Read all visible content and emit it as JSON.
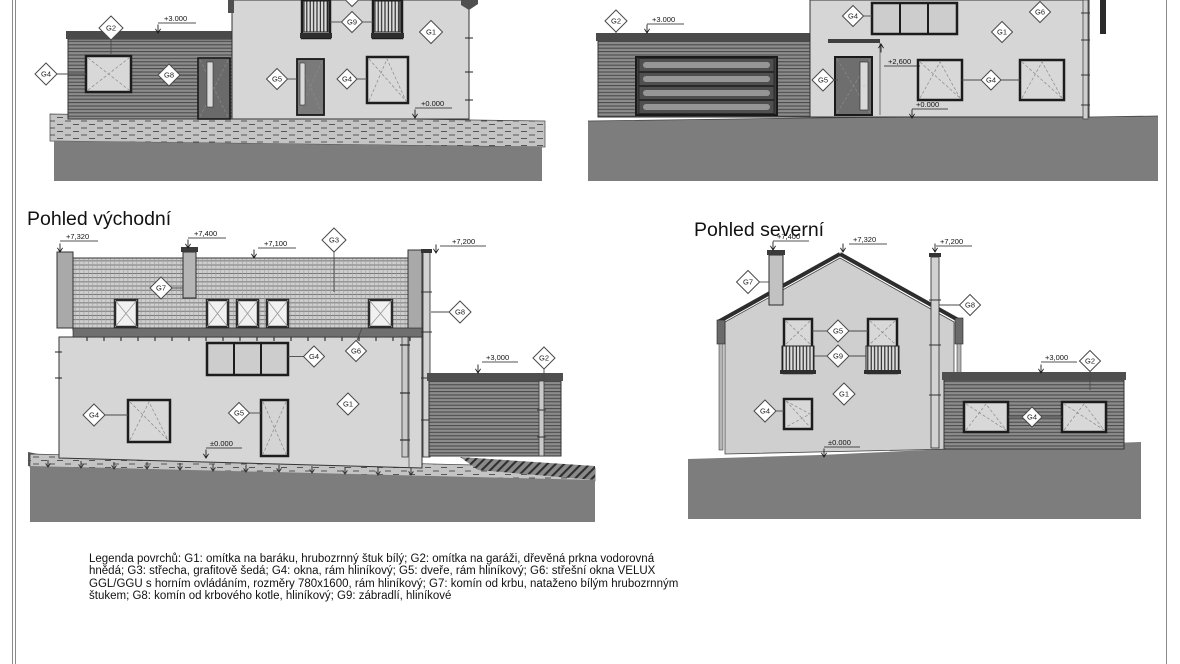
{
  "sheet": {
    "background": "#ffffff",
    "colors": {
      "wall": "#d6d6d6",
      "wood_cladding": "#8c8c8c",
      "roof_tiles": "#cecece",
      "ground": "#7d7d7d",
      "dark_band": "#4a4a4a"
    }
  },
  "elevations": {
    "top_left": {
      "markers": {
        "g2": "G2",
        "g4": "G4",
        "g8": "G8",
        "g9": "G9",
        "g1": "G1",
        "g5": "G5",
        "g4b": "G4"
      },
      "levels": {
        "roof": "+3.000",
        "ground": "+0.000"
      }
    },
    "top_right": {
      "markers": {
        "g2": "G2",
        "g4_top": "G4",
        "g6": "G6",
        "g1": "G1",
        "g5": "G5",
        "g4_mid": "G4"
      },
      "levels": {
        "roof": "+3.000",
        "canopy": "+2,600",
        "ground": "+0.000"
      }
    },
    "east": {
      "title": "Pohled východní",
      "markers": {
        "g3": "G3",
        "g7": "G7",
        "g6": "G6",
        "g8": "G8",
        "g4_top": "G4",
        "g4_left": "G4",
        "g5": "G5",
        "g1": "G1",
        "g2": "G2"
      },
      "levels": {
        "ridge": "+7,320",
        "chimney": "+7,400",
        "eaves": "+7,100",
        "pipe": "+7,200",
        "garage": "+3,000",
        "ground": "±0.000"
      }
    },
    "north": {
      "title": "Pohled severní",
      "markers": {
        "g7": "G7",
        "g8": "G8",
        "g5": "G5",
        "g9": "G9",
        "g1": "G1",
        "g4": "G4",
        "g4_garage": "G4",
        "g2": "G2"
      },
      "levels": {
        "chimney": "+7,400",
        "ridge": "+7,320",
        "pipe": "+7,200",
        "garage": "+3,000",
        "ground": "±0.000"
      }
    }
  },
  "legend": {
    "lines": [
      "Legenda povrchů:  G1: omítka na baráku,  hrubozrnný štuk bílý; G2: omítka na garáži, dřevěná prkna vodorovná",
      "hnědá; G3: střecha, grafitově šedá; G4: okna, rám hliníkový; G5: dveře, rám hliníkový; G6: střešní okna VELUX",
      "GGL/GGU s horním ovládáním, rozměry 780x1600, rám hliníkový; G7: komín od krbu, nataženo bílým hrubozrnným",
      "štukem; G8: komín od krbového kotle, hliníkový; G9: zábradlí, hliníkové"
    ]
  }
}
